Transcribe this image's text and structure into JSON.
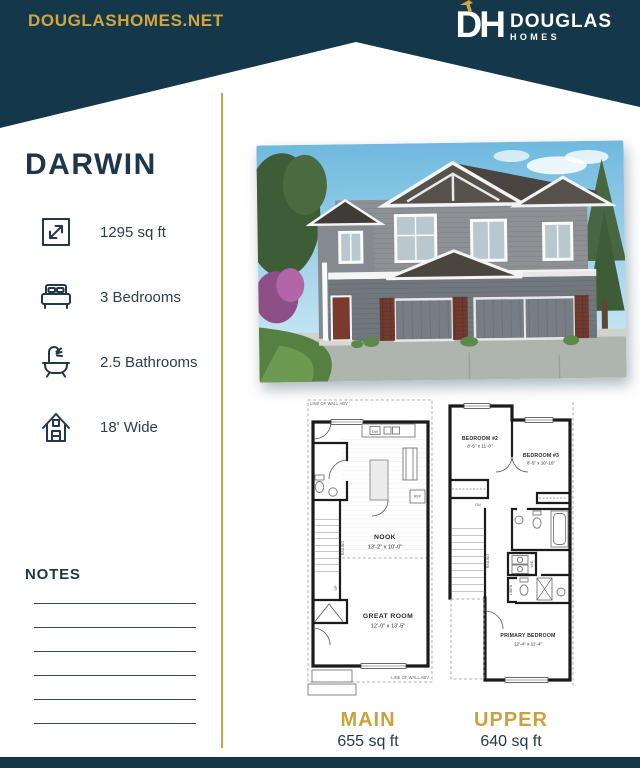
{
  "header": {
    "website": "DOUGLASHOMES.NET",
    "logo": {
      "monogram": "DH",
      "name": "DOUGLAS",
      "sub": "HOMES"
    }
  },
  "plan": {
    "name": "DARWIN",
    "specs": [
      {
        "icon": "area-expand-icon",
        "label": "1295 sq ft"
      },
      {
        "icon": "bed-icon",
        "label": "3 Bedrooms"
      },
      {
        "icon": "bathtub-icon",
        "label": "2.5 Bathrooms"
      },
      {
        "icon": "house-width-icon",
        "label": "18' Wide"
      }
    ]
  },
  "notes": {
    "title": "NOTES",
    "line_count": 6
  },
  "floorplans": {
    "main": {
      "label": "MAIN",
      "area": "655 sq ft",
      "annotation_top": "LINE OF WALL ABV",
      "annotation_bottom": "LINE OF WALL ABV",
      "rooms": [
        {
          "name": "NOOK",
          "dims": "13'-2\" x 10'-0\""
        },
        {
          "name": "GREAT ROOM",
          "dims": "12'-0\" x 13'-5\""
        }
      ],
      "micro": {
        "dw": "DW",
        "ref": "REF",
        "railing": "RAILING",
        "up": "UP"
      }
    },
    "upper": {
      "label": "UPPER",
      "area": "640 sq ft",
      "rooms": [
        {
          "name": "BEDROOM #2",
          "dims": "8'-5\" x 11'-0\""
        },
        {
          "name": "BEDROOM #3",
          "dims": "8'-5\" x 10'-10\""
        },
        {
          "name": "PRIMARY BEDROOM",
          "dims": "12'-4\" x 11'-4\""
        }
      ],
      "micro": {
        "dn": "DN",
        "wd": "W/D",
        "linen": "LINEN",
        "railing": "RAILING"
      }
    }
  },
  "colors": {
    "teal": "#14384a",
    "gold": "#c9a23c",
    "navy": "#1e3649"
  }
}
